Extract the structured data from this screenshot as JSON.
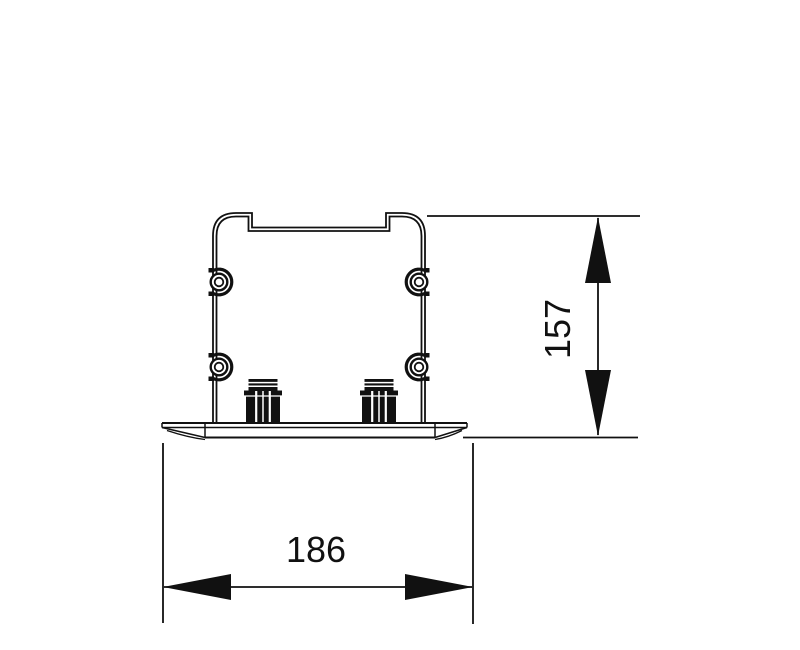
{
  "canvas": {
    "width_px": 800,
    "height_px": 650,
    "background": "#ffffff",
    "line_color": "#111111"
  },
  "dimensions": {
    "height": {
      "value": "157",
      "orientation": "vertical"
    },
    "width": {
      "value": "186",
      "orientation": "horizontal"
    }
  }
}
